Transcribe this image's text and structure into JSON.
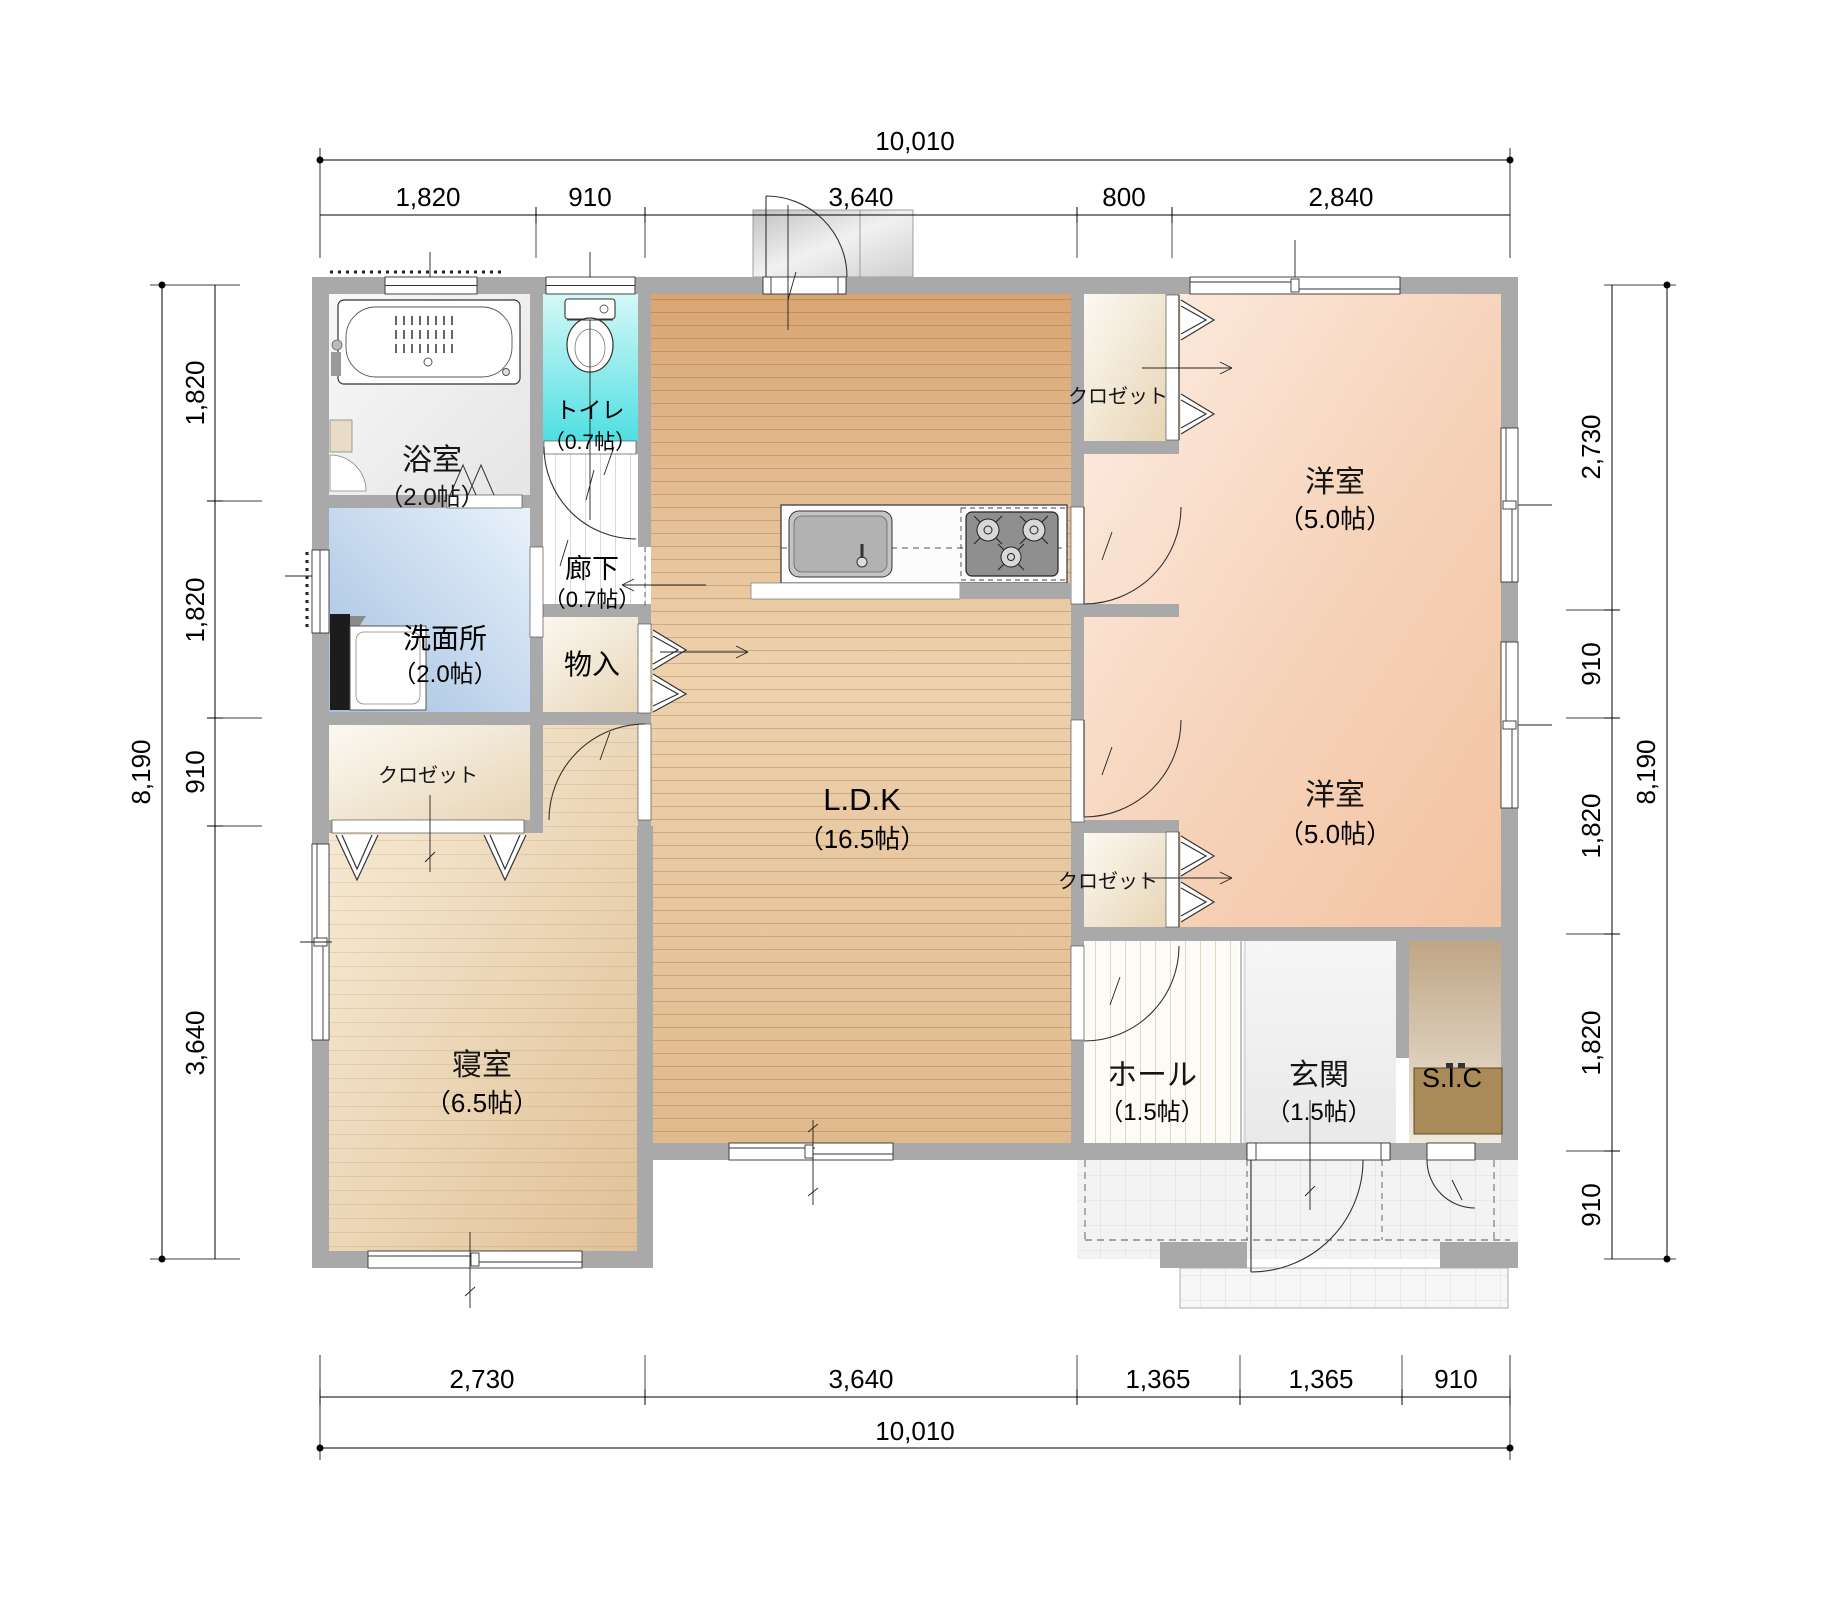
{
  "rooms": {
    "bath": {
      "label": "浴室",
      "area": "（2.0帖）"
    },
    "toilet": {
      "label": "トイレ",
      "area": "（0.7帖）"
    },
    "corridor": {
      "label": "廊下",
      "area": "（0.7帖）"
    },
    "washroom": {
      "label": "洗面所",
      "area": "（2.0帖）"
    },
    "storage": {
      "label": "物入"
    },
    "closet_bedroom": {
      "label": "クロゼット"
    },
    "closet_west1": {
      "label": "クロゼット"
    },
    "closet_west2": {
      "label": "クロゼット"
    },
    "bedroom": {
      "label": "寝室",
      "area": "（6.5帖）"
    },
    "ldk": {
      "label": "L.D.K",
      "area": "（16.5帖）"
    },
    "western_room1": {
      "label": "洋室",
      "area": "（5.0帖）"
    },
    "western_room2": {
      "label": "洋室",
      "area": "（5.0帖）"
    },
    "hall": {
      "label": "ホール",
      "area": "（1.5帖）"
    },
    "entrance": {
      "label": "玄関",
      "area": "（1.5帖）"
    },
    "sic": {
      "label": "S.I.C"
    }
  },
  "dimensions": {
    "top": {
      "total": "10,010",
      "segments": [
        "1,820",
        "910",
        "3,640",
        "800",
        "2,840"
      ]
    },
    "bottom": {
      "total": "10,010",
      "segments": [
        "2,730",
        "3,640",
        "1,365",
        "1,365",
        "910"
      ]
    },
    "left": {
      "total": "8,190",
      "segments": [
        "1,820",
        "1,820",
        "910",
        "3,640"
      ]
    },
    "right": {
      "total": "8,190",
      "segments": [
        "2,730",
        "910",
        "1,820",
        "1,820",
        "910"
      ]
    }
  },
  "colors": {
    "wall": "#a9a9a9",
    "wood_floor": "#d8a471",
    "western_room_floor": "#f3c3a2",
    "bedroom_floor": "#e0c096",
    "washroom_floor": "#a3c0e0",
    "toilet_floor": "#4fdfe2",
    "closet_floor": "#e7d5b5",
    "sic_cabinet": "#a98a58"
  }
}
